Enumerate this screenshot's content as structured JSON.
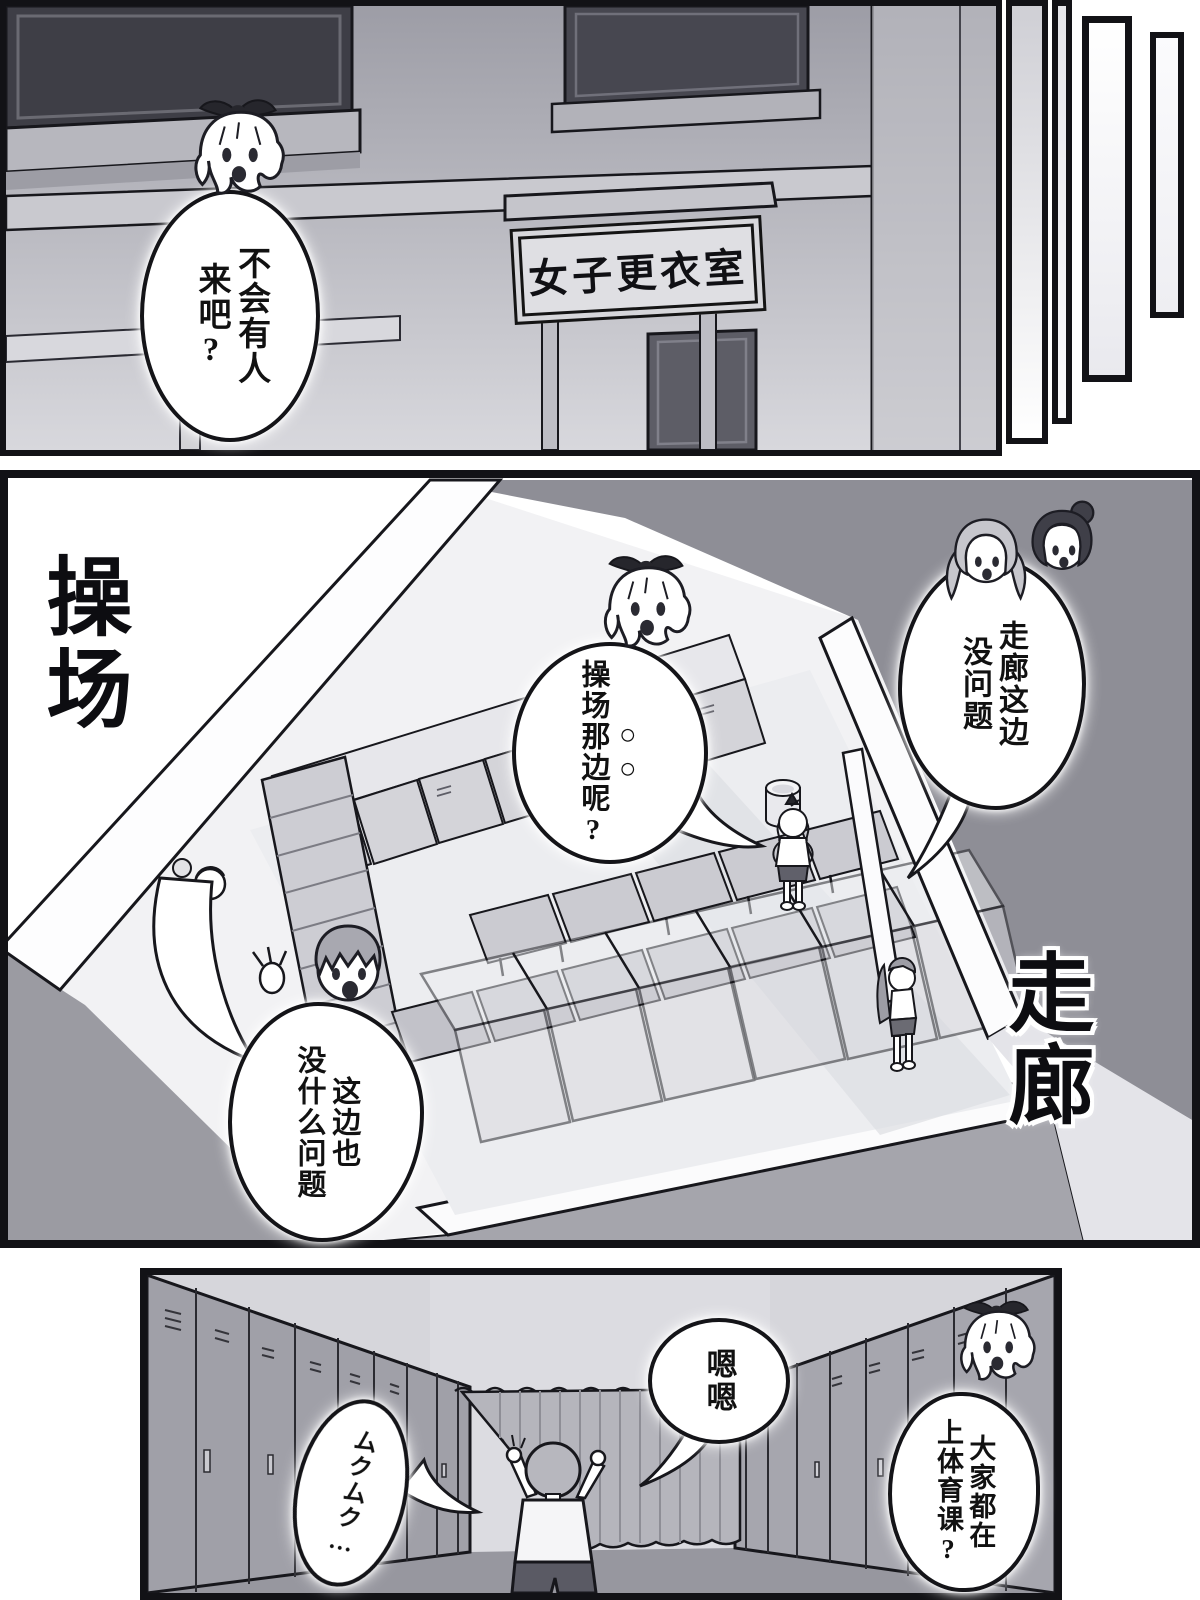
{
  "colors": {
    "ink": "#17171c",
    "paper": "#ffffff",
    "dark_wall": "#8e8e96",
    "mid_wall": "#b7b7be",
    "light_wall": "#d8d8dd",
    "locker": "#d4d4d9",
    "floor": "#ecedf0",
    "curtain": "#b5b5bc"
  },
  "panel_top": {
    "sign_text": "女子更衣室",
    "bubble_lines": [
      "不会有人",
      "来吧?"
    ]
  },
  "panel_middle": {
    "label_left": "操场",
    "label_right": "走廊",
    "bubble_center_lines": [
      "○○",
      "操场那边呢?"
    ],
    "bubble_right_lines": [
      "走廊这边",
      "没问题"
    ],
    "bubble_left_lines": [
      "这边也",
      "没什么问题"
    ]
  },
  "panel_bottom": {
    "bubble_hum": "嗯嗯",
    "bubble_sfx": "ムクムク…",
    "bubble_girl_lines": [
      "大家都在",
      "上体育课?"
    ]
  }
}
